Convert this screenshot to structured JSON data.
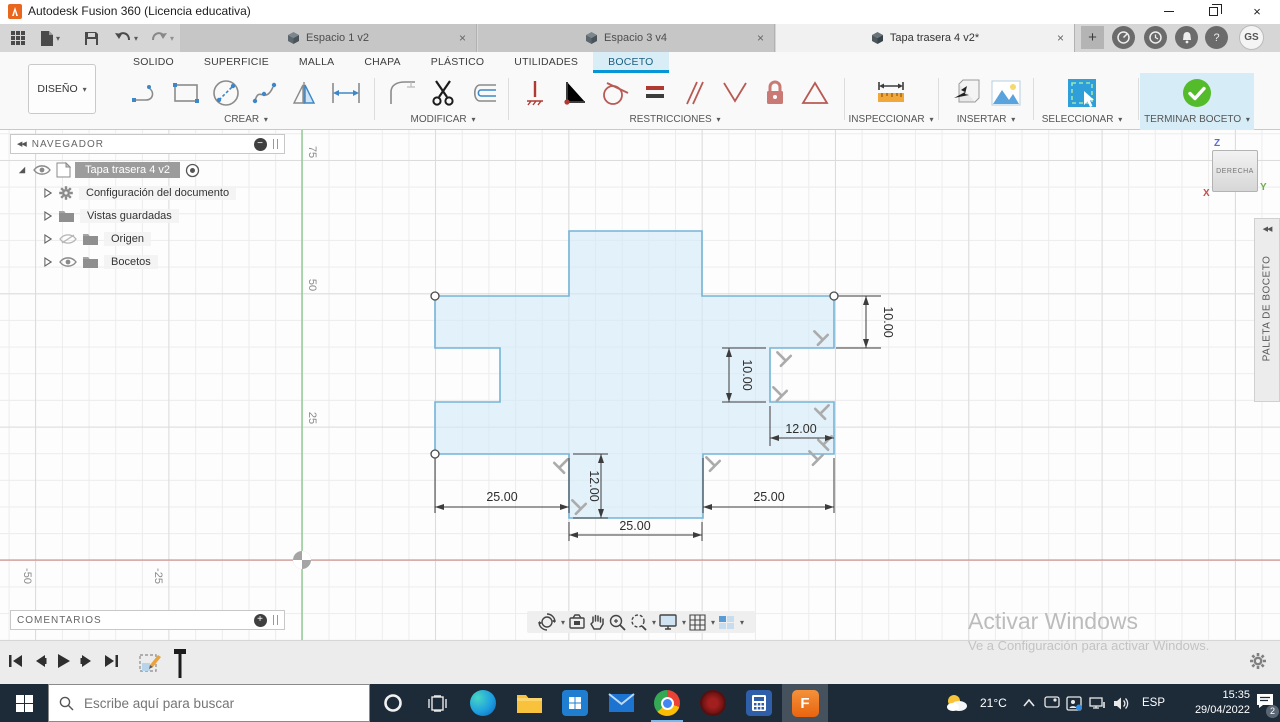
{
  "icons": {
    "caret": "▾",
    "close": "×",
    "plus": "+",
    "collapse": "◀◀",
    "minus": "−",
    "plus_small": "+"
  },
  "titlebar": {
    "title": "Autodesk Fusion 360 (Licencia educativa)"
  },
  "doc_tabs": [
    {
      "label": "Espacio 1 v2"
    },
    {
      "label": "Espacio 3 v4"
    },
    {
      "label": "Tapa trasera 4 v2*"
    }
  ],
  "avatar": "GS",
  "ribbon": {
    "workspace_label": "DISEÑO",
    "tabs": [
      "SOLIDO",
      "SUPERFICIE",
      "MALLA",
      "CHAPA",
      "PLÁSTICO",
      "UTILIDADES",
      "BOCETO"
    ],
    "groups": {
      "crear": "CREAR",
      "modificar": "MODIFICAR",
      "restricciones": "RESTRICCIONES",
      "inspeccionar": "INSPECCIONAR",
      "insertar": "INSERTAR",
      "seleccionar": "SELECCIONAR",
      "terminar": "TERMINAR BOCETO"
    }
  },
  "navigator": {
    "header": "NAVEGADOR",
    "root_label": "Tapa trasera 4 v2",
    "items": [
      "Configuración del documento",
      "Vistas guardadas",
      "Origen",
      "Bocetos"
    ]
  },
  "comments": {
    "header": "COMENTARIOS"
  },
  "viewcube": {
    "face": "DERECHA",
    "axis_z": "Z",
    "axis_x": "X",
    "axis_y": "Y"
  },
  "palette": {
    "tab_label": "PALETA DE BOCETO"
  },
  "canvas_axis": {
    "y_ticks": [
      "75",
      "50",
      "25"
    ],
    "x_ticks": [
      "-50",
      "-25"
    ]
  },
  "sketch": {
    "dimensions": [
      {
        "value": "10.00"
      },
      {
        "value": "10.00"
      },
      {
        "value": "12.00"
      },
      {
        "value": "12.00"
      },
      {
        "value": "25.00"
      },
      {
        "value": "25.00"
      },
      {
        "value": "25.00"
      }
    ]
  },
  "watermark": {
    "line1": "Activar Windows",
    "line2": "Ve a Configuración para activar Windows."
  },
  "taskbar": {
    "search_placeholder": "Escribe aquí para buscar",
    "temperature": "21°C",
    "language": "ESP",
    "time": "15:35",
    "date": "29/04/2022",
    "notification_count": "2"
  },
  "colors": {
    "accent_blue": "#0696d7",
    "sketch_line": "#74b4d8",
    "terminar_green": "#54bb2a",
    "taskbar_bg": "#1d2b39"
  }
}
